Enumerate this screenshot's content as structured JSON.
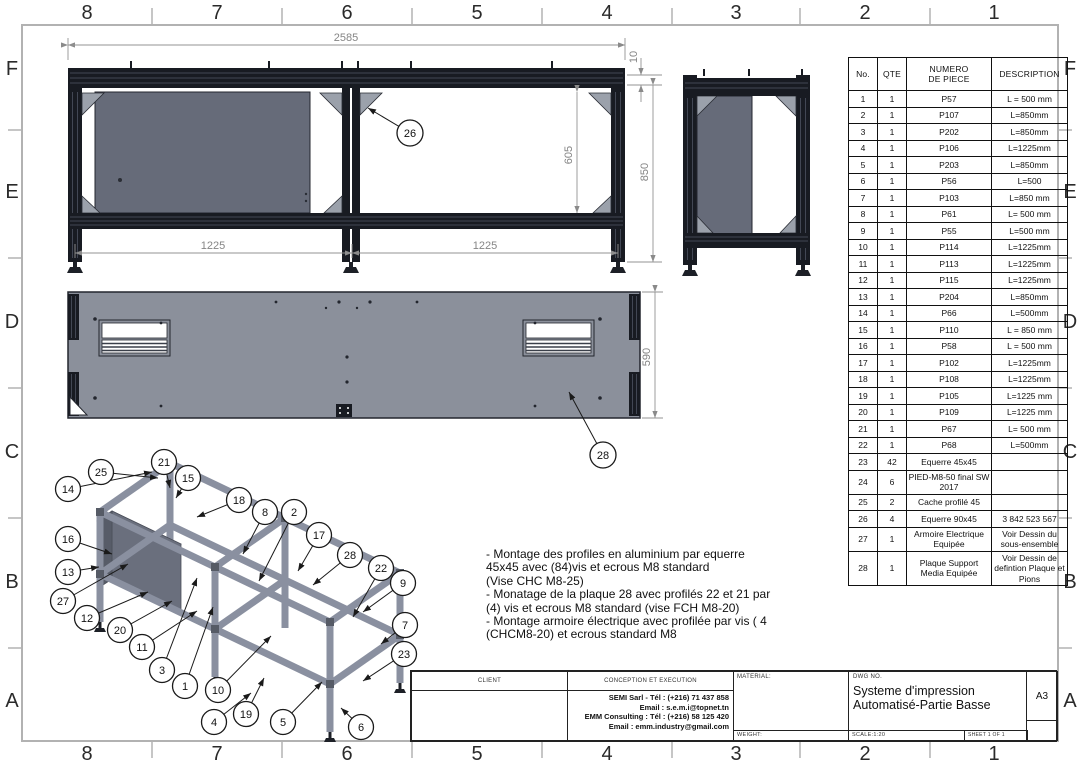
{
  "sheet": {
    "zones_top": [
      "8",
      "7",
      "6",
      "5",
      "4",
      "3",
      "2",
      "1"
    ],
    "zones_bottom": [
      "8",
      "7",
      "6",
      "5",
      "4",
      "3",
      "2",
      "1"
    ],
    "zones_left": [
      "F",
      "E",
      "D",
      "C",
      "B",
      "A"
    ],
    "zones_right": [
      "F",
      "E",
      "D",
      "C",
      "B",
      "A"
    ]
  },
  "front_view": {
    "dim_total": "2585",
    "dim_offset": "10",
    "dim_height": "850",
    "dim_inner": "605",
    "dim_bay_left": "1225",
    "dim_bay_right": "1225",
    "balloon": "26"
  },
  "plan_view": {
    "dim_height": "590",
    "balloon": "28"
  },
  "iso_view": {
    "balloons": [
      "14",
      "25",
      "21",
      "15",
      "18",
      "16",
      "13",
      "27",
      "12",
      "20",
      "11",
      "8",
      "2",
      "17",
      "28",
      "22",
      "9",
      "7",
      "23",
      "3",
      "1",
      "10",
      "19",
      "4",
      "5",
      "6"
    ]
  },
  "notes": {
    "lines": [
      "- Montage des profiles en aluminium par equerre",
      "45x45 avec (84)vis et ecrous M8 standard",
      "(Vise CHC M8-25)",
      "- Monatage de la plaque 28 avec profilés 22 et 21 par",
      "(4) vis et ecrous M8 standard (vise FCH M8-20)",
      "- Montage armoire électrique avec profilée par vis ( 4",
      "(CHCM8-20) et ecrous standard M8"
    ]
  },
  "bom": {
    "headers": [
      "No.",
      "QTE",
      "NUMERO\nDE PIECE",
      "DESCRIPTION"
    ],
    "rows": [
      [
        "1",
        "1",
        "P57",
        "L = 500 mm"
      ],
      [
        "2",
        "1",
        "P107",
        "L=850mm"
      ],
      [
        "3",
        "1",
        "P202",
        "L=850mm"
      ],
      [
        "4",
        "1",
        "P106",
        "L=1225mm"
      ],
      [
        "5",
        "1",
        "P203",
        "L=850mm"
      ],
      [
        "6",
        "1",
        "P56",
        "L=500"
      ],
      [
        "7",
        "1",
        "P103",
        "L=850 mm"
      ],
      [
        "8",
        "1",
        "P61",
        "L= 500 mm"
      ],
      [
        "9",
        "1",
        "P55",
        "L=500 mm"
      ],
      [
        "10",
        "1",
        "P114",
        "L=1225mm"
      ],
      [
        "11",
        "1",
        "P113",
        "L=1225mm"
      ],
      [
        "12",
        "1",
        "P115",
        "L=1225mm"
      ],
      [
        "13",
        "1",
        "P204",
        "L=850mm"
      ],
      [
        "14",
        "1",
        "P66",
        "L=500mm"
      ],
      [
        "15",
        "1",
        "P110",
        "L = 850 mm"
      ],
      [
        "16",
        "1",
        "P58",
        "L = 500 mm"
      ],
      [
        "17",
        "1",
        "P102",
        "L=1225mm"
      ],
      [
        "18",
        "1",
        "P108",
        "L=1225mm"
      ],
      [
        "19",
        "1",
        "P105",
        "L=1225 mm"
      ],
      [
        "20",
        "1",
        "P109",
        "L=1225 mm"
      ],
      [
        "21",
        "1",
        "P67",
        "L= 500 mm"
      ],
      [
        "22",
        "1",
        "P68",
        "L=500mm"
      ],
      [
        "23",
        "42",
        "Equerre 45x45",
        ""
      ],
      [
        "24",
        "6",
        "PIED-M8-50 final SW 2017",
        ""
      ],
      [
        "25",
        "2",
        "Cache profilé 45",
        ""
      ],
      [
        "26",
        "4",
        "Equerre 90x45",
        "3 842 523 567"
      ],
      [
        "27",
        "1",
        "Armoire Electrique Equipée",
        "Voir Dessin du sous-ensemble"
      ],
      [
        "28",
        "1",
        "Plaque Support Media Equipée",
        "Voir Dessin de defintion Plaque et Pions"
      ]
    ]
  },
  "title_block": {
    "client_label": "CLIENT",
    "conception_label": "CONCEPTION ET EXECUTION",
    "company_lines": [
      "SEMI Sarl - Tél : (+216) 71 437 858",
      "Email : s.e.m.i@topnet.tn",
      "EMM Consulting : Tél : (+216) 58 125 420",
      "Email : emm.industry@gmail.com"
    ],
    "material_label": "MATERIAL:",
    "weight_label": "WEIGHT:",
    "dwg_label": "DWG NO.",
    "title_line1": "Systeme d'impression",
    "title_line2": "Automatisé-Partie Basse",
    "scale": "SCALE:1:20",
    "sheet": "SHEET 1 OF 1",
    "size": "A3"
  }
}
